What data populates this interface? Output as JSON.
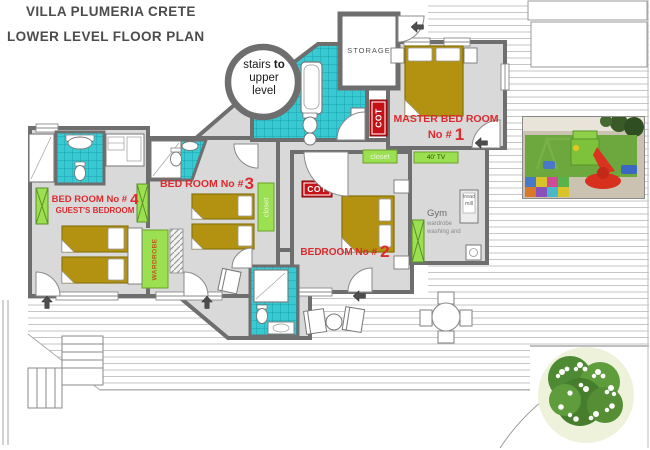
{
  "title": {
    "line1": "VILLA PLUMERIA CRETE",
    "line2": "LOWER LEVEL FLOOR PLAN"
  },
  "stairs": {
    "pre": "stairs ",
    "bold": "to",
    "line2": "upper",
    "line3": "level"
  },
  "rooms": {
    "storage": {
      "label": "STORAGE"
    },
    "master": {
      "name": "MASTER BED ROOM",
      "number_prefix": "No #",
      "number": "1"
    },
    "bedroom2": {
      "prefix": "BEDROOM No #",
      "number": "2"
    },
    "bedroom3": {
      "prefix": "BED ROOM No #",
      "number": "3"
    },
    "bedroom4": {
      "prefix": "BED ROOM No #",
      "number": "4",
      "subtitle": "GUEST'S BEDROOM"
    },
    "gym": {
      "name": "Gym",
      "line2": "wardrobe",
      "line3": "washing and"
    }
  },
  "labels": {
    "cot": "COT",
    "closet": "closet",
    "wardrobe": "WARDROBE",
    "tv": "40' TV",
    "treadmill": "tread mill"
  },
  "colors": {
    "wall": "#6e6e6e",
    "floor": "#d9d9d9",
    "bath_tile": "#39c9d3",
    "bed": "#b29210",
    "green_furniture": "#9be050",
    "room_label_red": "#dc2a2e",
    "cot_badge": "#c41116"
  }
}
